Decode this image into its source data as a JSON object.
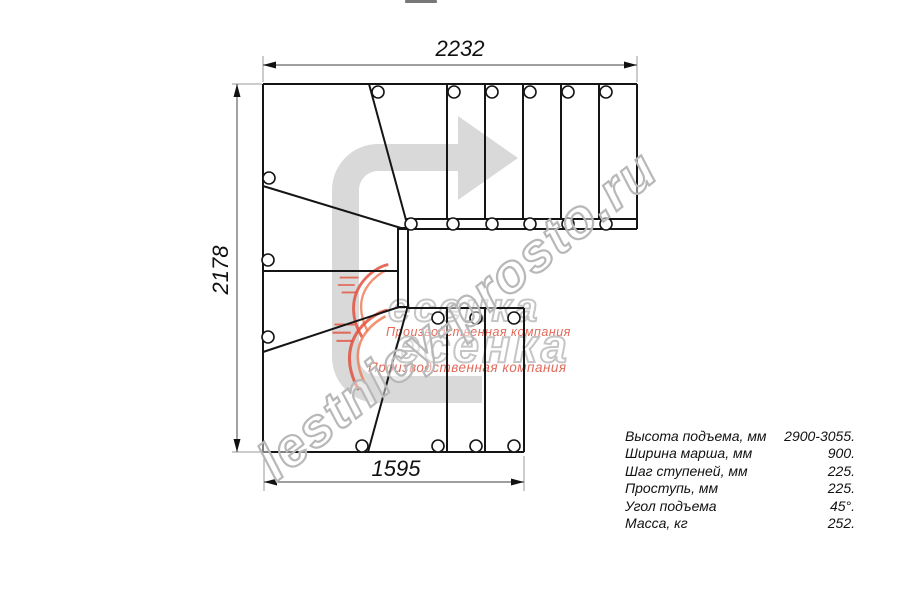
{
  "drawing_type": "staircase floor plan, 180-degree turn with winder steps",
  "dimensions": {
    "top": "2232",
    "left": "2178",
    "bottom": "1595"
  },
  "spec_table": {
    "rows": [
      {
        "label": "Высота подъема, мм",
        "value": "2900-3055."
      },
      {
        "label": "Ширина марша, мм",
        "value": "900."
      },
      {
        "label": "Шаг ступеней, мм",
        "value": "225."
      },
      {
        "label": "Проступь, мм",
        "value": "225."
      },
      {
        "label": "Угол подъема",
        "value": "45°."
      },
      {
        "label": "Масса, кг",
        "value": "252."
      }
    ]
  },
  "watermarks": {
    "url_text": "lestnicy-prosto.ru",
    "logo_text": "есенка",
    "logo_caption": "Производственная компания"
  },
  "colors": {
    "line": "#151515",
    "dimension_line": "#666666",
    "extension_line": "#999999",
    "arrow_fill": "#d9d9d9",
    "url_outline": "#b8b8b8",
    "logo_gray": "#bbbbbb",
    "logo_red": "#dd4f3d",
    "swoosh_red": "#e2503c",
    "swoosh_orange": "#ef7f5a"
  }
}
